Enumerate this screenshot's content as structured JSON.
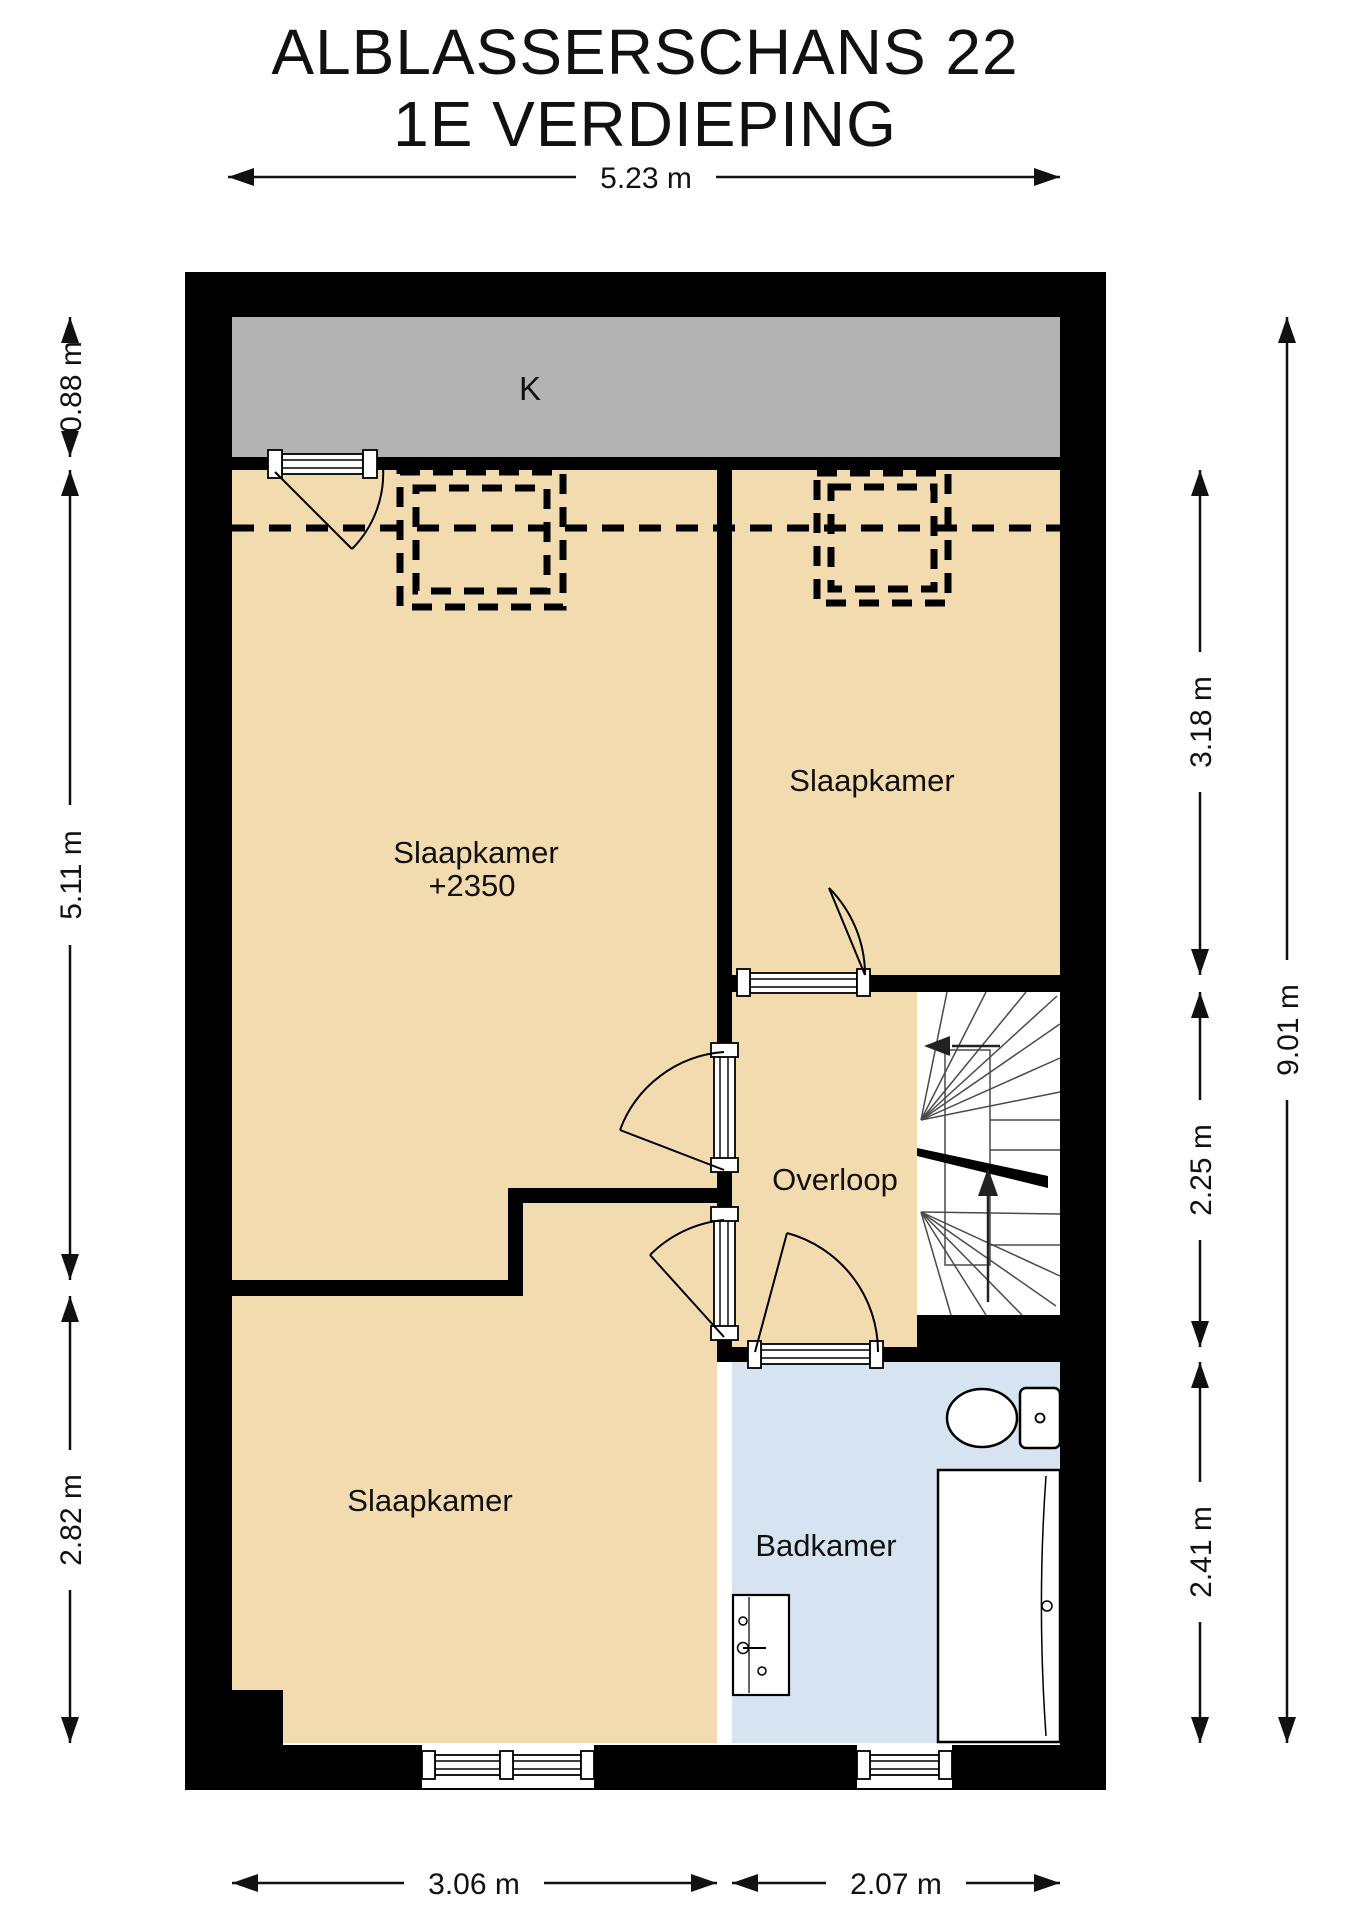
{
  "title": {
    "line1": "ALBLASSERSCHANS 22",
    "line2": "1E VERDIEPING"
  },
  "rooms": {
    "k": "K",
    "bedroom_large": "Slaapkamer",
    "bedroom_large_ceiling": "+2350",
    "bedroom_topright": "Slaapkamer",
    "bedroom_bottom": "Slaapkamer",
    "landing": "Overloop",
    "bathroom": "Badkamer"
  },
  "dimensions": {
    "top_width": "5.23 m",
    "left_top": "0.88 m",
    "left_middle": "5.11 m",
    "left_bottom": "2.82 m",
    "right_top": "3.18 m",
    "right_middle": "2.25 m",
    "right_bottom": "2.41 m",
    "right_total": "9.01 m",
    "bottom_left": "3.06 m",
    "bottom_right": "2.07 m"
  },
  "colors": {
    "wall": "#000000",
    "room_floor": "#f3dbb0",
    "low_ceiling_band": "#d8c09a",
    "roof_area_k": "#b3b3b3",
    "bathroom_floor": "#d6e4f1",
    "background": "#ffffff"
  }
}
